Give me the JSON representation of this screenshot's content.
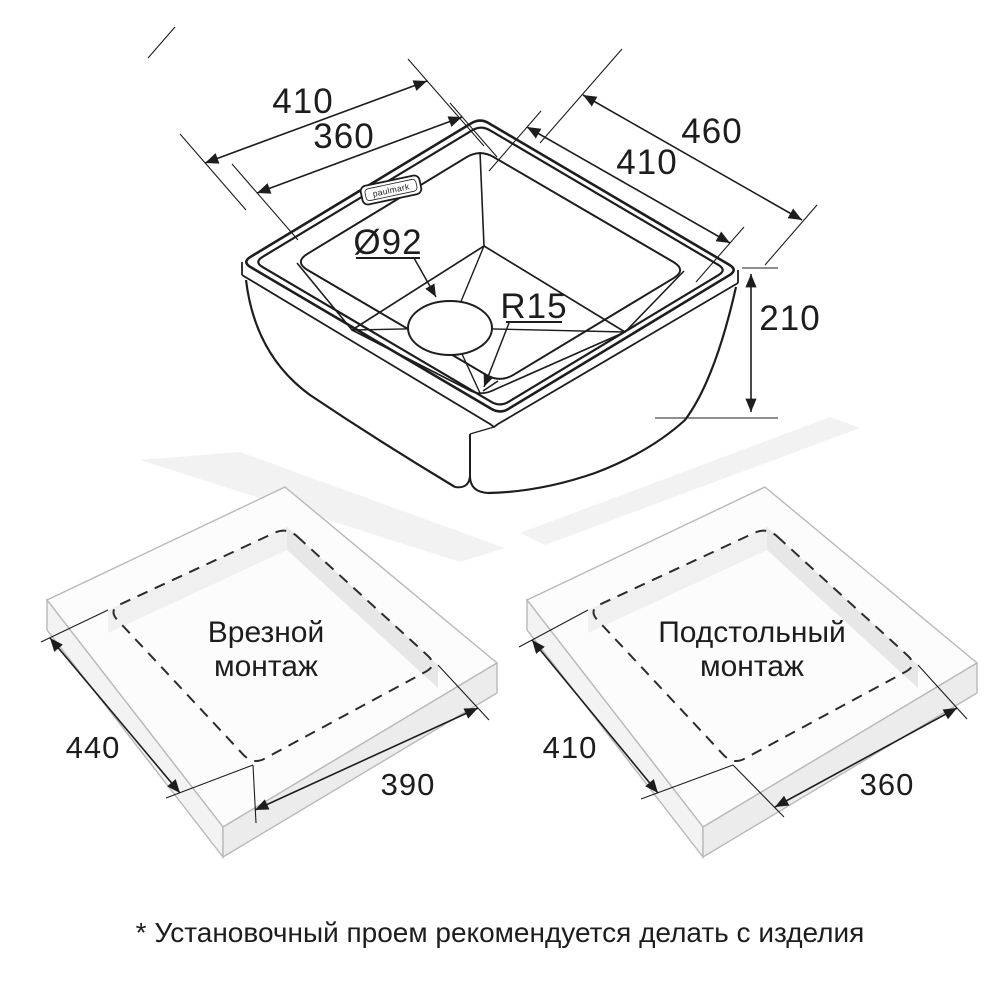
{
  "colors": {
    "ink": "#1d1d1d",
    "slab_top": "#fcfcfc",
    "slab_side_left": "#f3f3f3",
    "slab_side_right": "#ececec",
    "slab_edge": "#b9b9b9",
    "cut_wall_dark": "#e7e7e7",
    "cut_wall_light": "#f0f0f0",
    "shadow": "#f2f2f2"
  },
  "sink": {
    "brand": "paulmark",
    "outer_width": "410",
    "bowl_width": "360",
    "outer_length": "460",
    "bowl_length": "410",
    "depth": "210",
    "drain_diameter": "Ø92",
    "corner_radius": "R15"
  },
  "inset_mount": {
    "title_line1": "Врезной",
    "title_line2": "монтаж",
    "cut_width": "440",
    "cut_length": "390"
  },
  "under_mount": {
    "title_line1": "Подстольный",
    "title_line2": "монтаж",
    "cut_width": "410",
    "cut_length": "360"
  },
  "footnote": "* Установочный проем рекомендуется делать с изделия"
}
